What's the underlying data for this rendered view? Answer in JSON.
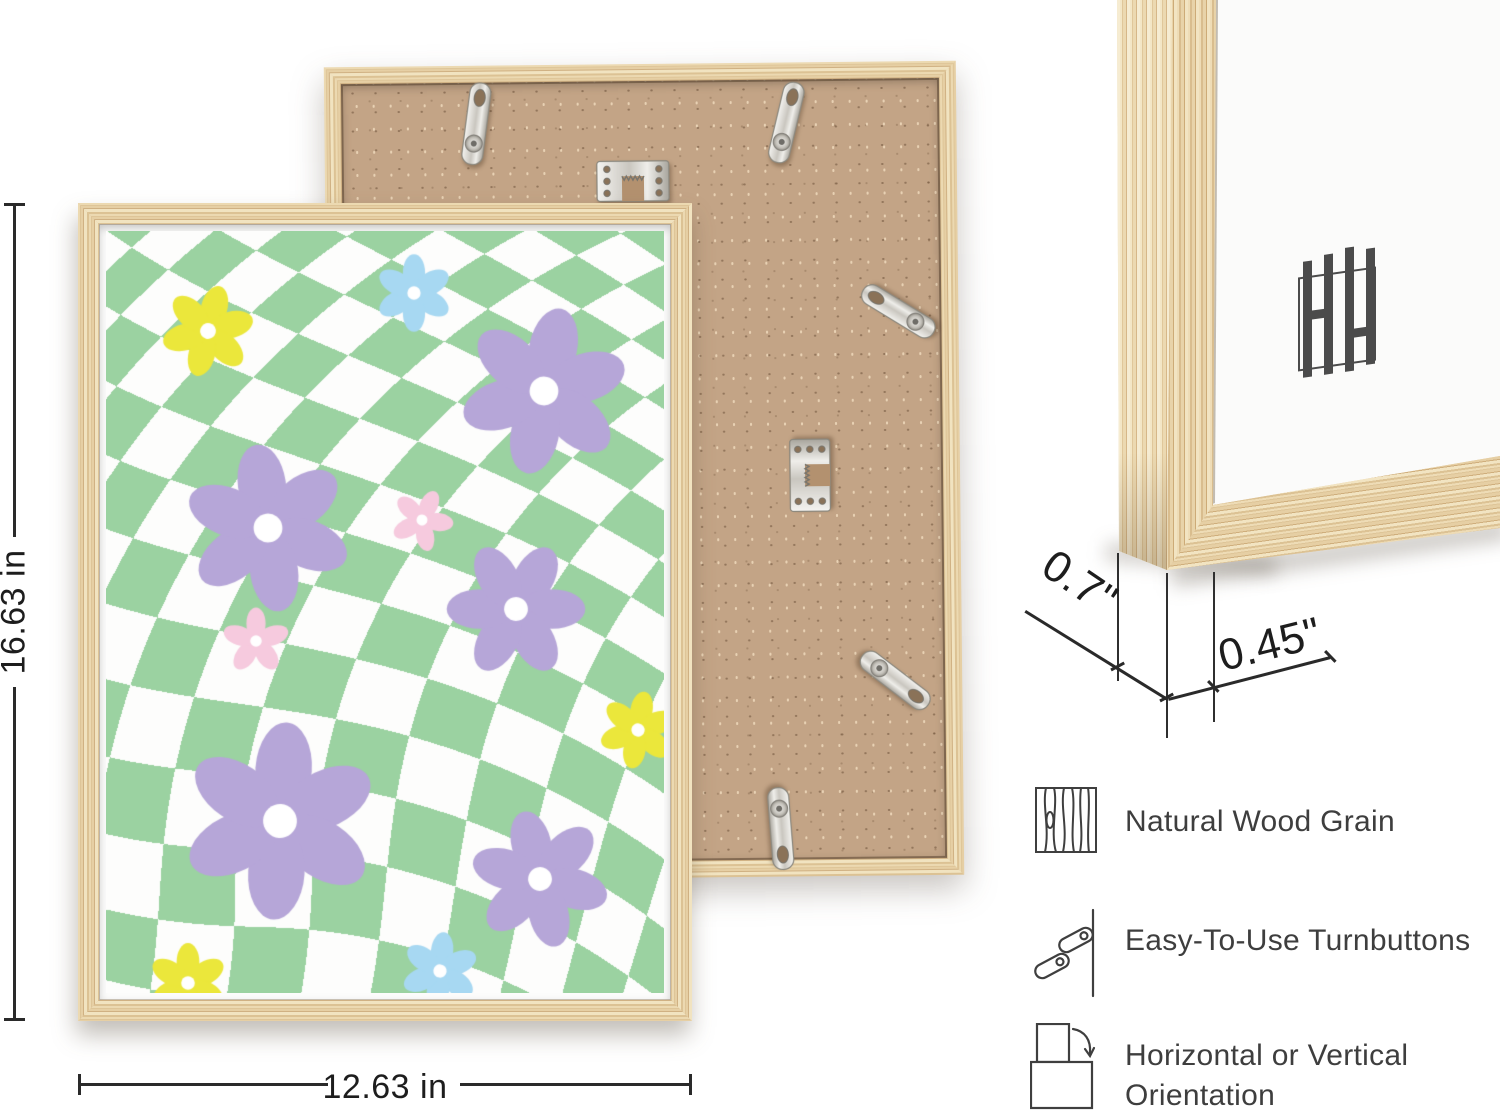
{
  "dimensions": {
    "height_label": "16.63 in",
    "width_label": "12.63 in",
    "depth_label": "0.7\"",
    "face_label": "0.45\""
  },
  "features": [
    {
      "icon": "wood-grain-icon",
      "label": "Natural Wood Grain"
    },
    {
      "icon": "turnbutton-icon",
      "label": "Easy-To-Use Turnbuttons"
    },
    {
      "icon": "orientation-icon",
      "label": "Horizontal or Vertical Orientation"
    }
  ],
  "colors": {
    "wood": "#e3caa0",
    "wood_dark": "#cfae7b",
    "mdf": "#c3a486",
    "metal": "#d9d7d2",
    "line": "#2a2a2a",
    "text": "#3e3e3e",
    "logo": "#4b4b4b"
  },
  "artwork": {
    "checker": {
      "cell": 55,
      "green": "#9bd2a1",
      "white": "#fdfdfc",
      "twist": 0.62,
      "center": [
        140,
        660
      ],
      "radius": 780,
      "scale_boost": 0.42,
      "offset": [
        8,
        30
      ]
    },
    "flower_colors": {
      "purple": "#b6a6d8",
      "pink": "#f6cade",
      "blue": "#a7d8f2",
      "yellow": "#ebe73b",
      "center": "#ffffff"
    },
    "flowers": [
      {
        "c": "yellow",
        "x": 102,
        "y": 100,
        "r": 44,
        "rot": 15,
        "petals": 6
      },
      {
        "c": "blue",
        "x": 308,
        "y": 62,
        "r": 37,
        "rot": 0,
        "petals": 6
      },
      {
        "c": "purple",
        "x": 438,
        "y": 160,
        "r": 80,
        "rot": 12,
        "petals": 6
      },
      {
        "c": "purple",
        "x": 162,
        "y": 297,
        "r": 80,
        "rot": -8,
        "petals": 6
      },
      {
        "c": "pink",
        "x": 316,
        "y": 289,
        "r": 30,
        "rot": 25,
        "petals": 5
      },
      {
        "c": "purple",
        "x": 410,
        "y": 378,
        "r": 66,
        "rot": 30,
        "petals": 6
      },
      {
        "c": "pink",
        "x": 150,
        "y": 410,
        "r": 32,
        "rot": 0,
        "petals": 5
      },
      {
        "c": "purple",
        "x": 174,
        "y": 590,
        "r": 94,
        "rot": 4,
        "petals": 6
      },
      {
        "c": "yellow",
        "x": 532,
        "y": 499,
        "r": 37,
        "rot": 10,
        "petals": 6
      },
      {
        "c": "purple",
        "x": 434,
        "y": 648,
        "r": 66,
        "rot": -14,
        "petals": 6
      },
      {
        "c": "blue",
        "x": 334,
        "y": 740,
        "r": 37,
        "rot": 6,
        "petals": 6
      },
      {
        "c": "yellow",
        "x": 82,
        "y": 752,
        "r": 38,
        "rot": 0,
        "petals": 6
      }
    ]
  },
  "back_frame": {
    "hardware": [
      {
        "type": "turnbutton",
        "x": 137,
        "y": 15,
        "rot": 8
      },
      {
        "type": "turnbutton",
        "x": 447,
        "y": 17,
        "rot": 14
      },
      {
        "type": "turnbutton",
        "x": 557,
        "y": 207,
        "rot": -58
      },
      {
        "type": "turnbutton",
        "x": 550,
        "y": 576,
        "rot": 128
      },
      {
        "type": "turnbutton",
        "x": 434,
        "y": 723,
        "rot": 176
      },
      {
        "type": "sawtooth",
        "x": 271,
        "y": 96,
        "rot": 0
      },
      {
        "type": "sawtooth",
        "x": 445,
        "y": 392,
        "rot": -90
      }
    ]
  }
}
